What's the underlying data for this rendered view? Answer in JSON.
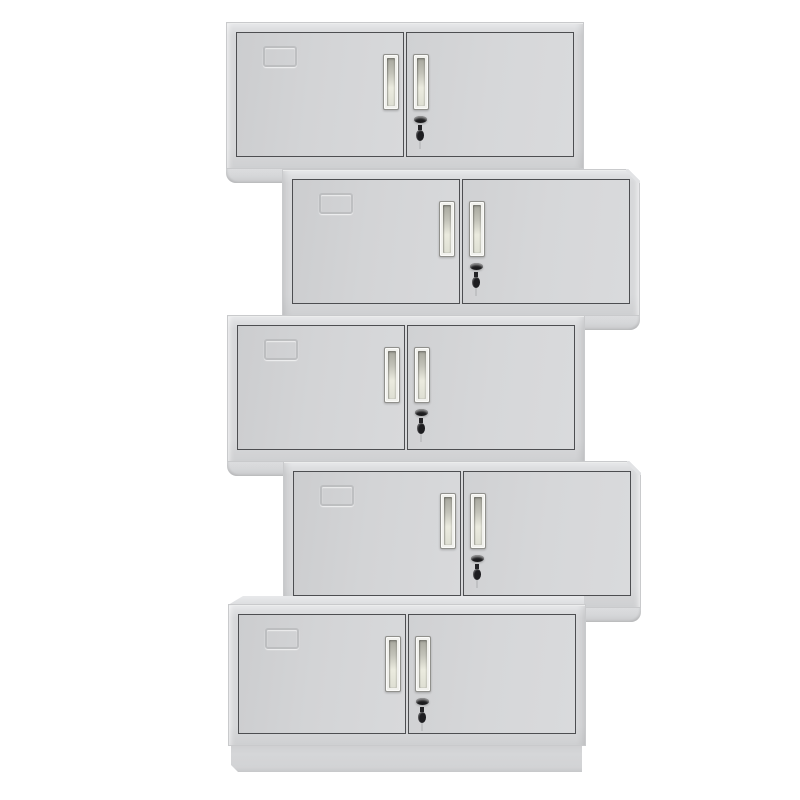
{
  "scene": {
    "type": "product-photo",
    "description": "Five grey two-door steel office cabinets stacked in an alternating zigzag on a white background",
    "background_color": "#ffffff",
    "cabinet_count": 5,
    "unit": {
      "width": 358,
      "body_height": 147,
      "foot_height": 15,
      "plinth_height": 26
    },
    "cabinets": [
      {
        "name": "cabinet-1",
        "left": 226,
        "top": 22,
        "align": "left",
        "foot": true,
        "corner_facet": false,
        "plinth": false,
        "top_face": false
      },
      {
        "name": "cabinet-2",
        "left": 282,
        "top": 169,
        "align": "right",
        "foot": true,
        "corner_facet": true,
        "plinth": false,
        "top_face": false
      },
      {
        "name": "cabinet-3",
        "left": 227,
        "top": 315,
        "align": "left",
        "foot": true,
        "corner_facet": false,
        "plinth": false,
        "top_face": false
      },
      {
        "name": "cabinet-4",
        "left": 283,
        "top": 461,
        "align": "right",
        "foot": true,
        "corner_facet": true,
        "plinth": false,
        "top_face": false
      },
      {
        "name": "cabinet-5",
        "left": 228,
        "top": 604,
        "align": "left",
        "foot": false,
        "corner_facet": false,
        "plinth": true,
        "top_face": true,
        "body_height": 142
      }
    ],
    "parts_per_cabinet": [
      "label-card-holder",
      "left-door",
      "right-door",
      "left-door-handle",
      "right-door-handle",
      "door-lock",
      "hanging-key"
    ],
    "colors": {
      "background": "#ffffff",
      "body": "#d7d8da",
      "body_edge": "#c9cacc",
      "body_top_highlight": "#eceded",
      "door": "#d3d4d6",
      "door_border": "#4d4e51",
      "handle_plate": "#f1f1ed",
      "handle_recess_dark": "#a7a79d",
      "handle_recess_light": "#ebebdf",
      "lock_black": "#1b1b1d",
      "key_black": "#1d1d20",
      "emboss_line": "#a8a9ac",
      "plinth": "#d5d6d8"
    }
  }
}
